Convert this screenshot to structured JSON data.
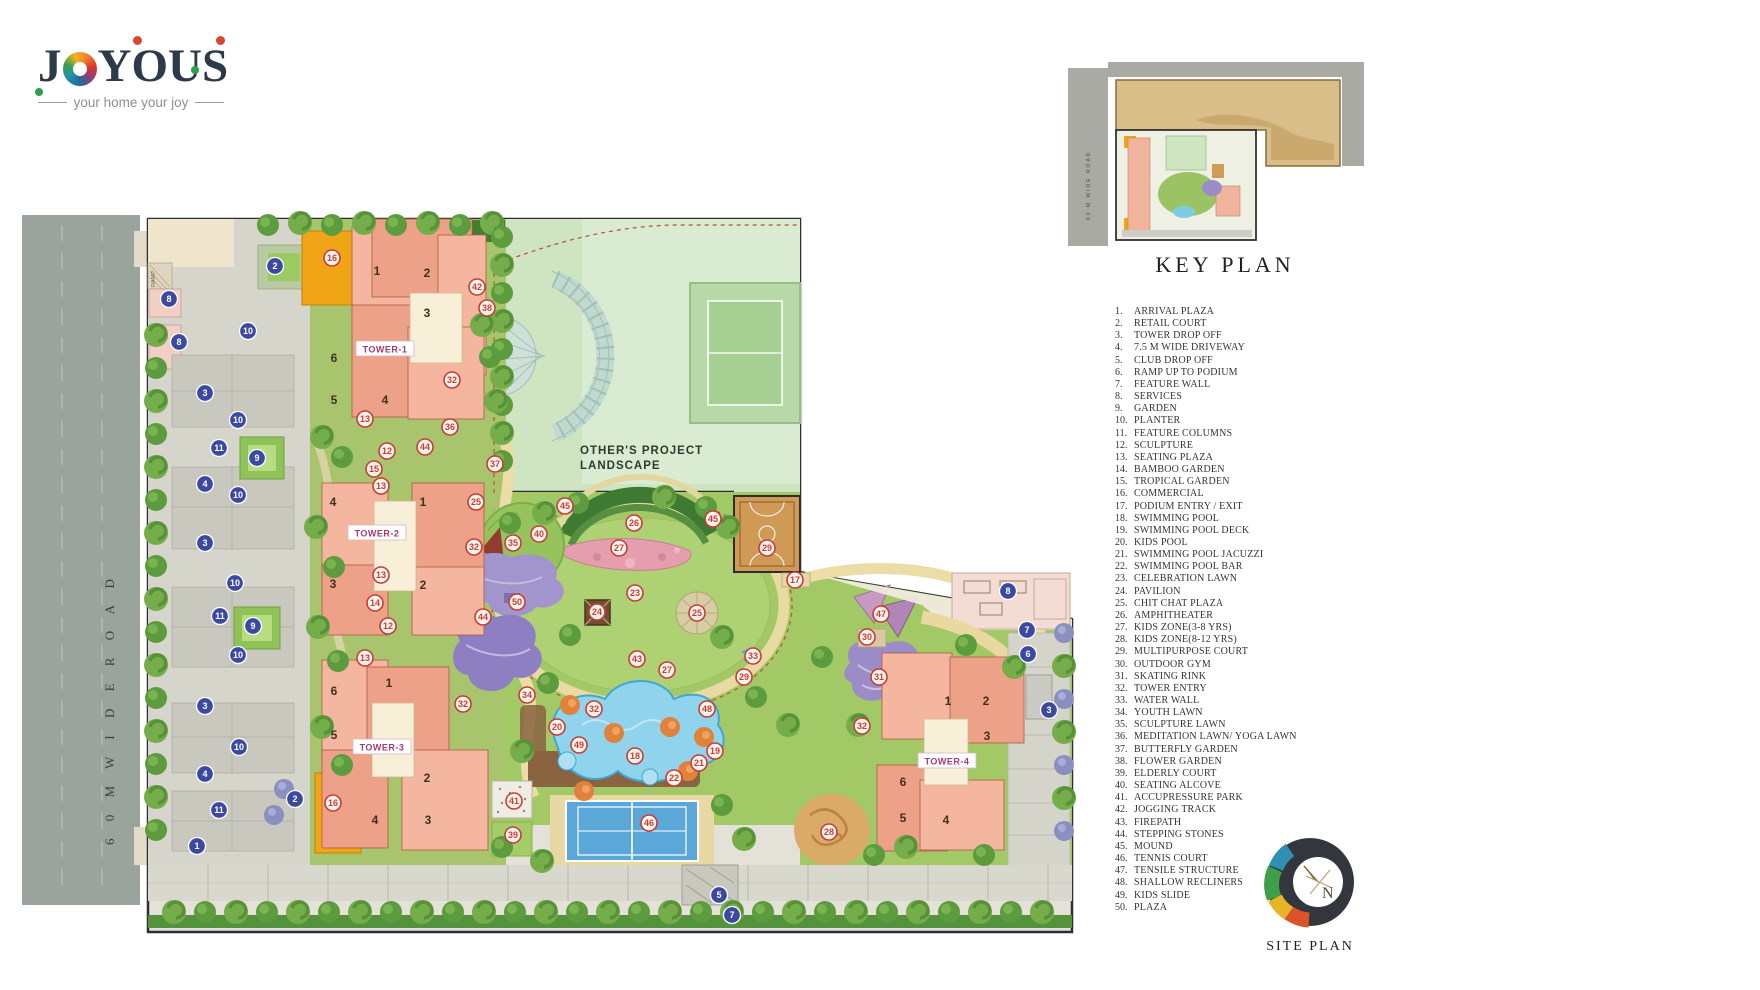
{
  "brand": {
    "wordmark_j": "J",
    "wordmark_rest": "YOUS",
    "tagline": "your home your joy"
  },
  "key_plan": {
    "title": "KEY PLAN",
    "road_label": "60 M WIDE ROAD"
  },
  "legend": {
    "items": [
      {
        "n": "1.",
        "t": "ARRIVAL PLAZA"
      },
      {
        "n": "2.",
        "t": "RETAIL COURT"
      },
      {
        "n": "3.",
        "t": "TOWER DROP OFF"
      },
      {
        "n": "4.",
        "t": "7.5 M WIDE DRIVEWAY"
      },
      {
        "n": "5.",
        "t": "CLUB DROP OFF"
      },
      {
        "n": "6.",
        "t": "RAMP UP TO PODIUM"
      },
      {
        "n": "7.",
        "t": "FEATURE WALL"
      },
      {
        "n": "8.",
        "t": "SERVICES"
      },
      {
        "n": "9.",
        "t": "GARDEN"
      },
      {
        "n": "10.",
        "t": "PLANTER"
      },
      {
        "n": "11.",
        "t": "FEATURE COLUMNS"
      },
      {
        "n": "12.",
        "t": "SCULPTURE"
      },
      {
        "n": "13.",
        "t": "SEATING PLAZA"
      },
      {
        "n": "14.",
        "t": "BAMBOO GARDEN"
      },
      {
        "n": "15.",
        "t": "TROPICAL GARDEN"
      },
      {
        "n": "16.",
        "t": "COMMERCIAL"
      },
      {
        "n": "17.",
        "t": "PODIUM ENTRY / EXIT"
      },
      {
        "n": "18.",
        "t": "SWIMMING POOL"
      },
      {
        "n": "19.",
        "t": "SWIMMING POOL DECK"
      },
      {
        "n": "20.",
        "t": "KIDS POOL"
      },
      {
        "n": "21.",
        "t": "SWIMMING POOL JACUZZI"
      },
      {
        "n": "22.",
        "t": "SWIMMING POOL BAR"
      },
      {
        "n": "23.",
        "t": "CELEBRATION LAWN"
      },
      {
        "n": "24.",
        "t": "PAVILION"
      },
      {
        "n": "25.",
        "t": "CHIT CHAT PLAZA"
      },
      {
        "n": "26.",
        "t": "AMPHITHEATER"
      },
      {
        "n": "27.",
        "t": "KIDS ZONE(3-8 YRS)"
      },
      {
        "n": "28.",
        "t": "KIDS ZONE(8-12 YRS)"
      },
      {
        "n": "29.",
        "t": "MULTIPURPOSE COURT"
      },
      {
        "n": "30.",
        "t": "OUTDOOR GYM"
      },
      {
        "n": "31.",
        "t": "SKATING RINK"
      },
      {
        "n": "32.",
        "t": "TOWER ENTRY"
      },
      {
        "n": "33.",
        "t": "WATER WALL"
      },
      {
        "n": "34.",
        "t": "YOUTH LAWN"
      },
      {
        "n": "35.",
        "t": "SCULPTURE LAWN"
      },
      {
        "n": "36.",
        "t": "MEDITATION LAWN/ YOGA LAWN"
      },
      {
        "n": "37.",
        "t": "BUTTERFLY GARDEN"
      },
      {
        "n": "38.",
        "t": "FLOWER GARDEN"
      },
      {
        "n": "39.",
        "t": "ELDERLY COURT"
      },
      {
        "n": "40.",
        "t": "SEATING ALCOVE"
      },
      {
        "n": "41.",
        "t": "ACCUPRESSURE PARK"
      },
      {
        "n": "42.",
        "t": "JOGGING TRACK"
      },
      {
        "n": "43.",
        "t": "FIREPATH"
      },
      {
        "n": "44.",
        "t": "STEPPING STONES"
      },
      {
        "n": "45.",
        "t": "MOUND"
      },
      {
        "n": "46.",
        "t": "TENNIS COURT"
      },
      {
        "n": "47.",
        "t": "TENSILE STRUCTURE"
      },
      {
        "n": "48.",
        "t": "SHALLOW RECLINERS"
      },
      {
        "n": "49.",
        "t": "KIDS SLIDE"
      },
      {
        "n": "50.",
        "t": "PLAZA"
      }
    ]
  },
  "site_plan": {
    "road_label": "6 0 M     W I D E     R O A D",
    "others_project_line1": "OTHER'S  PROJECT",
    "others_project_line2": "LANDSCAPE",
    "ramp_label": "RAMP",
    "towers": [
      {
        "name": "TOWER-1",
        "x": 363,
        "y": 144,
        "units": [
          [
            "1",
            355,
            70
          ],
          [
            "2",
            405,
            72
          ],
          [
            "3",
            405,
            112
          ],
          [
            "6",
            312,
            157
          ],
          [
            "5",
            312,
            199
          ],
          [
            "4",
            363,
            199
          ]
        ]
      },
      {
        "name": "TOWER-2",
        "x": 355,
        "y": 328,
        "units": [
          [
            "4",
            311,
            301
          ],
          [
            "1",
            401,
            301
          ],
          [
            "3",
            311,
            383
          ],
          [
            "2",
            401,
            384
          ]
        ]
      },
      {
        "name": "TOWER-3",
        "x": 360,
        "y": 542,
        "units": [
          [
            "6",
            312,
            490
          ],
          [
            "1",
            367,
            482
          ],
          [
            "5",
            312,
            534
          ],
          [
            "2",
            405,
            577
          ],
          [
            "4",
            353,
            619
          ],
          [
            "3",
            406,
            619
          ]
        ]
      },
      {
        "name": "TOWER-4",
        "x": 925,
        "y": 556,
        "units": [
          [
            "1",
            926,
            500
          ],
          [
            "2",
            964,
            500
          ],
          [
            "3",
            965,
            535
          ],
          [
            "6",
            881,
            581
          ],
          [
            "5",
            881,
            617
          ],
          [
            "4",
            924,
            619
          ]
        ]
      }
    ],
    "markers": {
      "blue": [
        [
          "2",
          253,
          61
        ],
        [
          "8",
          147,
          94
        ],
        [
          "8",
          157,
          137
        ],
        [
          "10",
          226,
          126
        ],
        [
          "3",
          183,
          188
        ],
        [
          "10",
          216,
          215
        ],
        [
          "11",
          197,
          243
        ],
        [
          "9",
          235,
          253
        ],
        [
          "4",
          183,
          279
        ],
        [
          "10",
          216,
          290
        ],
        [
          "3",
          183,
          338
        ],
        [
          "10",
          213,
          378
        ],
        [
          "11",
          198,
          411
        ],
        [
          "9",
          231,
          421
        ],
        [
          "10",
          216,
          450
        ],
        [
          "3",
          183,
          501
        ],
        [
          "10",
          217,
          542
        ],
        [
          "4",
          183,
          569
        ],
        [
          "11",
          197,
          605
        ],
        [
          "1",
          175,
          641
        ],
        [
          "2",
          273,
          594
        ],
        [
          "5",
          697,
          690
        ],
        [
          "7",
          710,
          710
        ],
        [
          "8",
          986,
          386
        ],
        [
          "7",
          1005,
          425
        ],
        [
          "6",
          1006,
          449
        ],
        [
          "3",
          1027,
          505
        ]
      ],
      "red": [
        [
          "16",
          310,
          53
        ],
        [
          "42",
          455,
          82
        ],
        [
          "38",
          465,
          103
        ],
        [
          "32",
          430,
          175
        ],
        [
          "36",
          428,
          222
        ],
        [
          "44",
          403,
          242
        ],
        [
          "13",
          343,
          214
        ],
        [
          "12",
          365,
          246
        ],
        [
          "15",
          352,
          264
        ],
        [
          "13",
          359,
          281
        ],
        [
          "37",
          473,
          259
        ],
        [
          "25",
          454,
          297
        ],
        [
          "45",
          543,
          301
        ],
        [
          "26",
          612,
          318
        ],
        [
          "27",
          597,
          343
        ],
        [
          "45",
          691,
          314
        ],
        [
          "29",
          745,
          343
        ],
        [
          "17",
          773,
          375
        ],
        [
          "35",
          491,
          338
        ],
        [
          "40",
          517,
          329
        ],
        [
          "32",
          452,
          342
        ],
        [
          "23",
          613,
          388
        ],
        [
          "24",
          575,
          407
        ],
        [
          "25",
          675,
          408
        ],
        [
          "50",
          495,
          397
        ],
        [
          "44",
          461,
          412
        ],
        [
          "13",
          359,
          370
        ],
        [
          "14",
          353,
          398
        ],
        [
          "12",
          366,
          421
        ],
        [
          "13",
          343,
          453
        ],
        [
          "43",
          615,
          454
        ],
        [
          "27",
          645,
          465
        ],
        [
          "33",
          731,
          451
        ],
        [
          "29",
          722,
          472
        ],
        [
          "34",
          505,
          490
        ],
        [
          "32",
          441,
          499
        ],
        [
          "32",
          572,
          504
        ],
        [
          "48",
          685,
          504
        ],
        [
          "20",
          535,
          522
        ],
        [
          "49",
          557,
          540
        ],
        [
          "18",
          613,
          551
        ],
        [
          "19",
          693,
          546
        ],
        [
          "21",
          677,
          558
        ],
        [
          "22",
          652,
          573
        ],
        [
          "46",
          627,
          618
        ],
        [
          "41",
          492,
          596
        ],
        [
          "39",
          491,
          630
        ],
        [
          "16",
          311,
          598
        ],
        [
          "47",
          859,
          409
        ],
        [
          "30",
          845,
          432
        ],
        [
          "31",
          857,
          472
        ],
        [
          "32",
          840,
          521
        ],
        [
          "28",
          807,
          627
        ]
      ]
    }
  },
  "site_logo": {
    "label": "SITE PLAN",
    "compass_letter": "N"
  }
}
